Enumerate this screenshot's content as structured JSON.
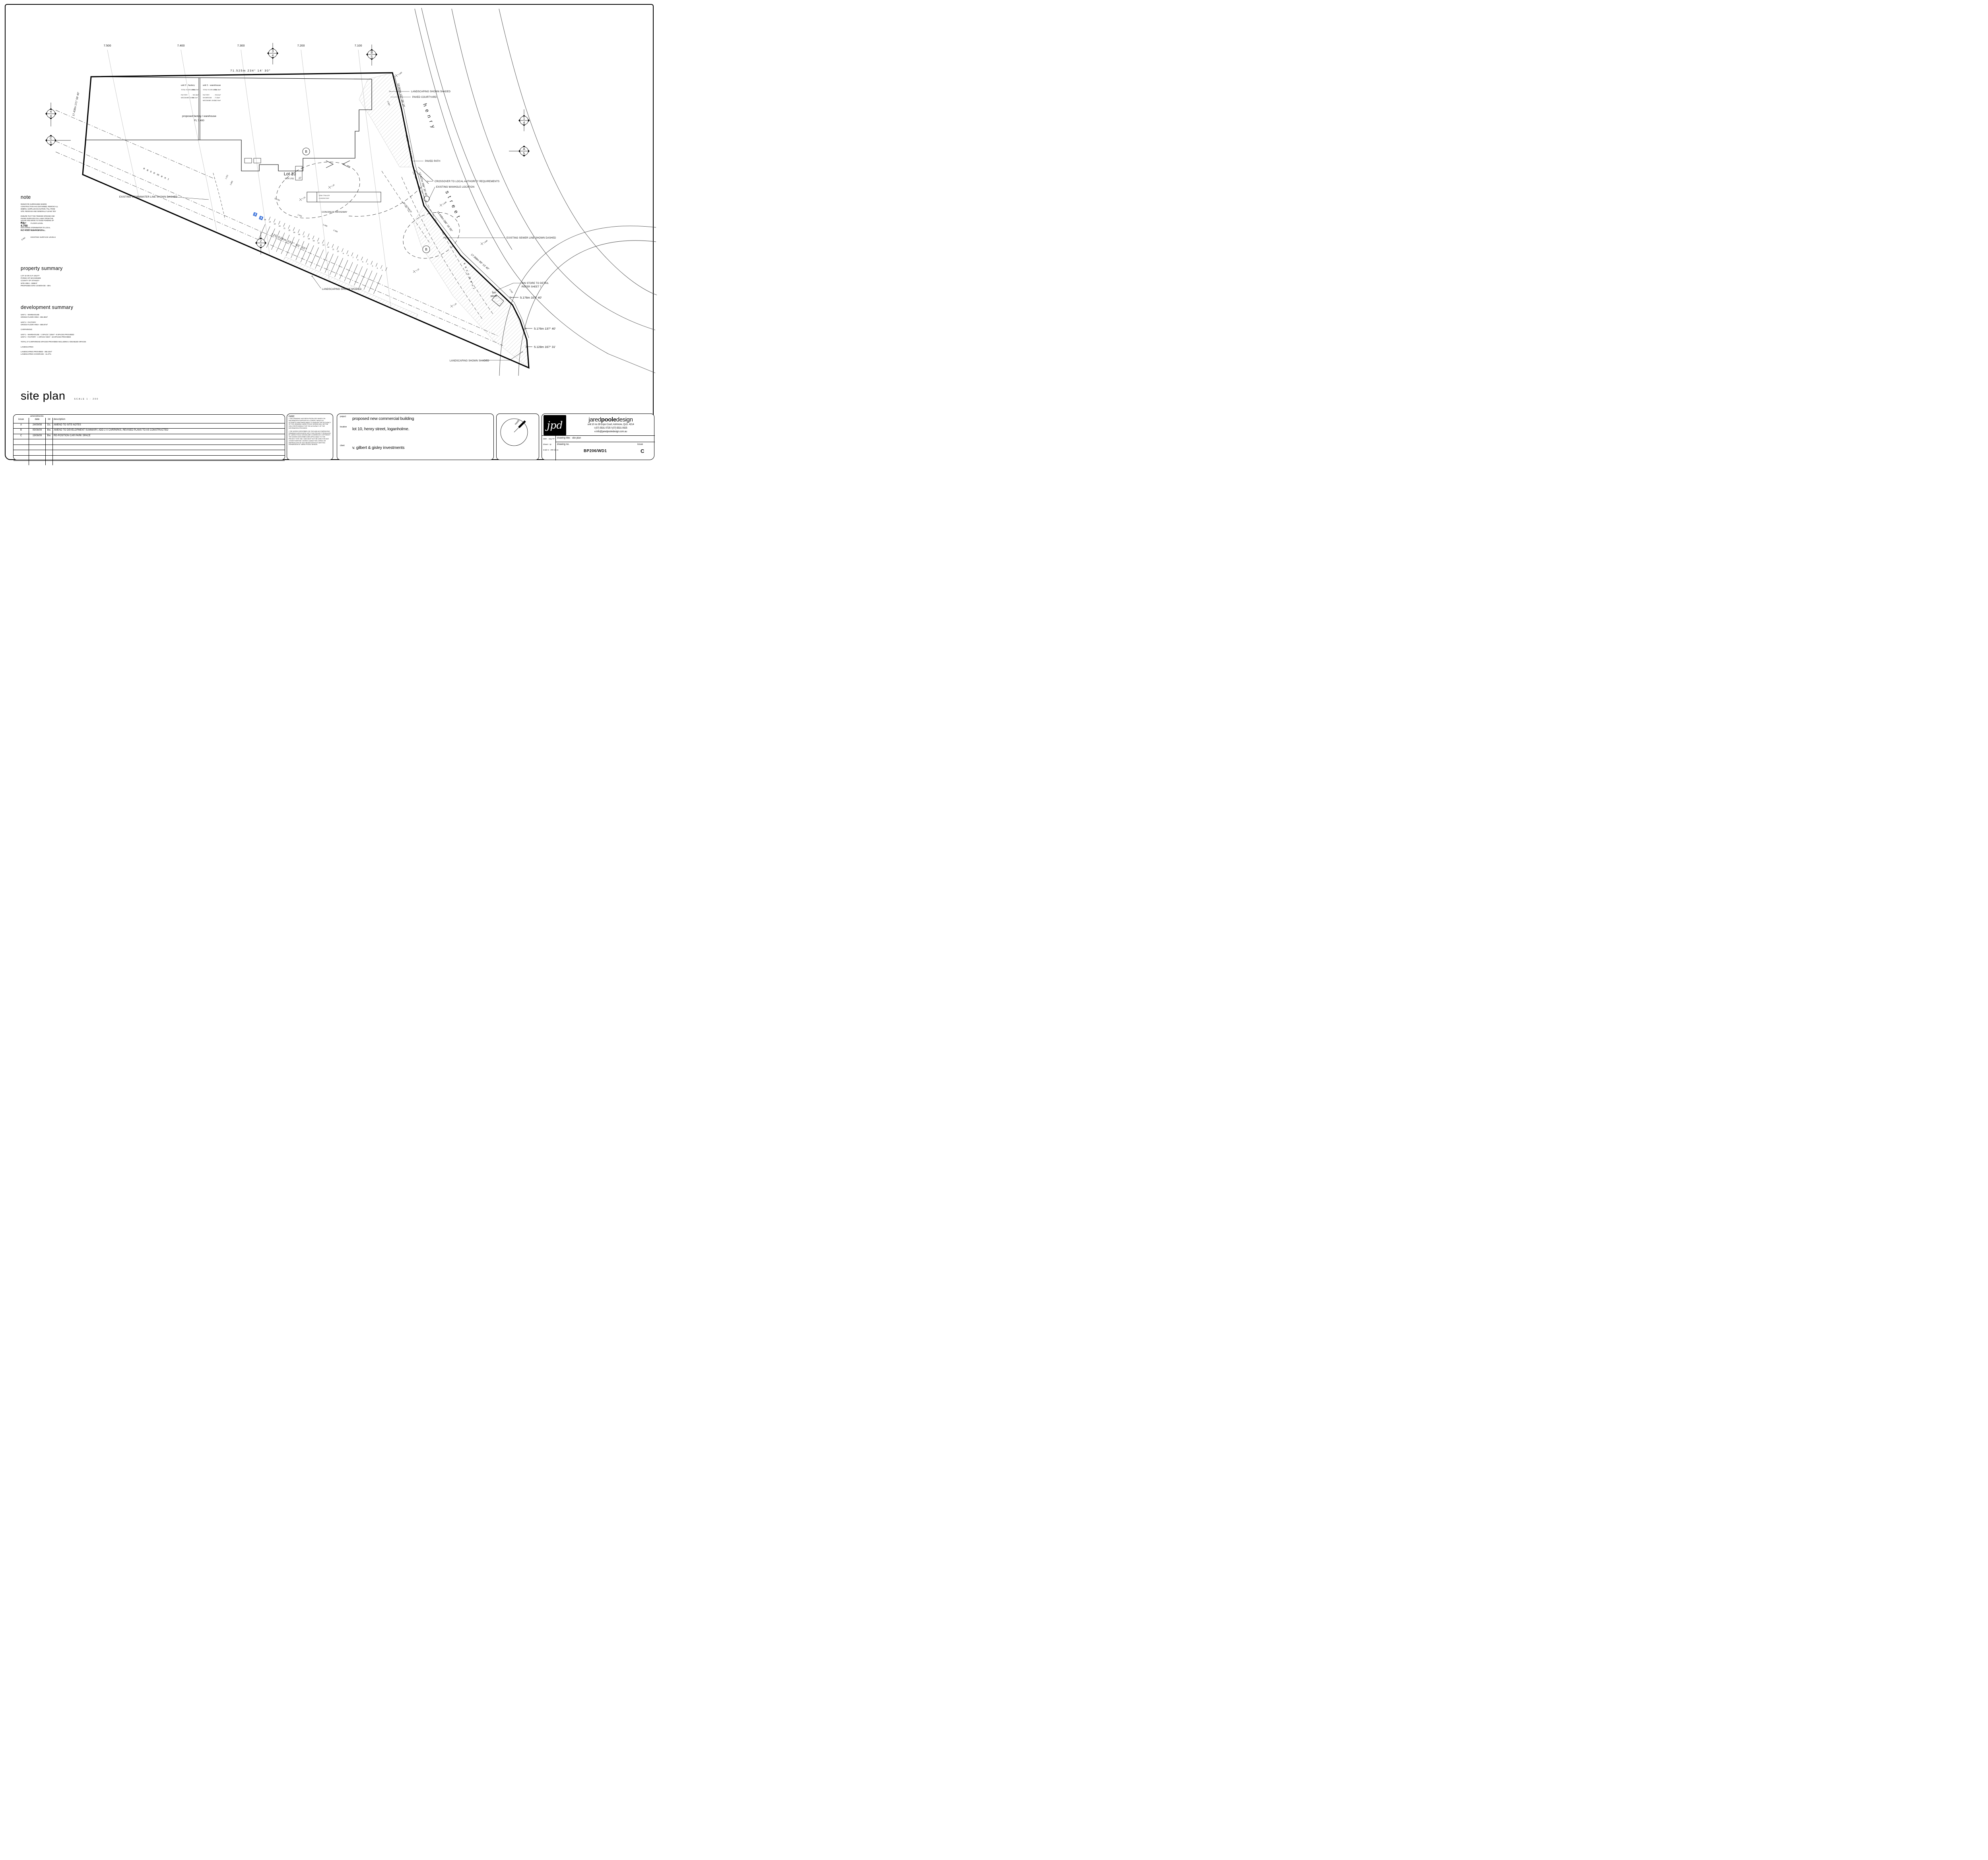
{
  "plan": {
    "contour_labels": [
      "7.500",
      "7.400",
      "7.300",
      "7.200",
      "7.100"
    ],
    "top_dim": "71.525m  234° 14' 30\"",
    "left_dim": "17.428m  171° 59' 40\"",
    "bottom_dim": "125.538m  262° 00' 30\"",
    "street_dims": [
      "10.043m  137° 06' 10\"",
      "12.837m  130° 54' 20\"",
      "12.837m  298° 30' 45\"",
      "14.448m  286° 16' 05\"",
      "17.368m  99° 13' 40\""
    ],
    "end_dims": [
      "5.176m  107° 40'",
      "5.176m  137° 40'",
      "5.128m  167° 31'"
    ],
    "markers": [
      {
        "top": "3",
        "bottom": "4"
      },
      {
        "top": "B",
        "bottom": "5"
      },
      {
        "top": "4",
        "bottom": "4"
      },
      {
        "top": "C",
        "bottom": "5"
      },
      {
        "top": "1",
        "bottom": "4"
      },
      {
        "top": "A",
        "bottom": "5"
      },
      {
        "top": "2",
        "bottom": "4"
      }
    ],
    "bubble": "B",
    "street_name_1": "henry",
    "street_name_2": "street",
    "easement": "easement",
    "setback_label": "8m SETBACK",
    "lot": {
      "title": "Lot 10",
      "sub": "GTP 1701",
      "space": "27"
    },
    "units": {
      "unit2": {
        "title": "unit 2 - factory",
        "rows": [
          {
            "label": "TOTAL FLOOR AREA",
            "value": "-   866.87m²"
          },
          {
            "label": "FACTORY",
            "value": "-   780.18m²"
          },
          {
            "label": "MEZZANINE LEVEL",
            "value": "-   86.01m²"
          }
        ]
      },
      "unit1": {
        "title": "unit 1 - warehouse",
        "rows": [
          {
            "label": "TOTAL FLOOR AREA",
            "value": "-   894.38m²"
          },
          {
            "label": "FACTORY",
            "value": "-   703.61m²"
          },
          {
            "label": "SHOWROOM",
            "value": "-   77.83m²"
          },
          {
            "label": "MEZZANINE LEVEL",
            "value": "-   112.94m²"
          }
        ]
      }
    },
    "building": {
      "label": "proposed factory / warehouse",
      "level": "FL 7.400"
    },
    "callouts": {
      "landscaping_top": "LANDSCAPING SHOWN SHADED",
      "paved_courtyard": "PAVED COURTYARD",
      "paved_path": "PAVED PATH",
      "crossover": "CROSSOVER TO LOCAL AUTHORITY REQUIREMENTS",
      "manhole": "EXISTING MANHOLE LOCATION",
      "sewer": "EXISTING SEWER LINE SHOWN DASHED",
      "bin_detail_1": "BIN STORE TO DETAIL",
      "bin_detail_2": "REFER SHEET 7",
      "bin_1": "bin",
      "bin_2": "store",
      "landscaping_bottom": "LANDSCAPING SHOWN SHADED",
      "landscaping_mid": "LANDSCAPING SHOWN SHADED",
      "stormwater": "EXISTING STORMWATER LINE SHOWN DASHED",
      "loading_1": "SEMI TRAILER",
      "loading_2": "LOADING BAY",
      "concrete": "CONCRETE DRIVEWAY"
    },
    "levels": [
      "7.040",
      "7.045",
      "7.040",
      "7.16",
      "7.31",
      "7.15",
      "7.19"
    ],
    "small_dims": {
      "a": "22.700",
      "b": "1.315",
      "c": "2.900",
      "d": "1.010",
      "e": "2.400",
      "f": "2.400",
      "g": "2.439",
      "h": "6,000"
    },
    "parking_numbers": [
      "25",
      "24",
      "23",
      "22",
      "21",
      "20",
      "19",
      "18",
      "17",
      "16",
      "15",
      "14",
      "13",
      "12",
      "11",
      "10",
      "9",
      "8",
      "7",
      "6",
      "5",
      "4",
      "3",
      "2",
      "1"
    ]
  },
  "notes": {
    "heading": "note",
    "paras": [
      "REINSTATE SURROUNDS WHERE CONSTRUCTION HAS DISTURBED, REMOVE ALL DEBRIS, SURPLUS EXCAVATION / FILL FROM SITE. REGRASS AND GENERALLY LEAVE TIDY",
      "ENSURE THAT THE FINISHED GROUND AND PAVING SURFACES FALL AWAY FROM THE HOUSE AND DRAIN TO AVOID PONDING OF WATER",
      "DISCHARGE STORMWATER TO LOCAL AUTHORITY REQUIREMENTS"
    ]
  },
  "legend": {
    "fl_value": "F.L. 4.750",
    "fl_label": "FLOOR LEVEL",
    "rl_value": "R.L. 4.500",
    "rl_label": "SURFACE LEVEL",
    "esl_value": "8.650",
    "esl_label": "EXISTING SURFACE LEVELS"
  },
  "property": {
    "heading": "property summary",
    "lines": [
      "LOT 10 ON S.P. 191277",
      "PARISH OF MACKENZIE",
      "COUNTY OF STANLEY",
      "SITE AREA - 3390m²",
      "PROPOSED SITE COVERAGE - 46%"
    ]
  },
  "development": {
    "heading": "development summary",
    "lines": [
      "UNIT 1 - WAREHOUSE",
      "GROSS FLOOR AREA - 894.38m²",
      "",
      "UNIT 2 - FACTORY",
      "GROSS FLOOR AREA - 866.87m²",
      "",
      "CARPARKING",
      "",
      "UNIT 1 - WAREHOUSE - 1 SPACE / 100m² - 9 SPACES PROVIDED",
      "UNIT 2 - FACTORY - 1 SPACE / 50m² - 18 SPACES PROVIDED",
      "",
      "TOTAL 27 CARPARKING SPACES PROVIDED INCLUDING 2 DISABLED SPACES",
      "",
      "LANDSCAPING",
      "",
      "LANDSCAPING PROVIDED - 382.22m²",
      "LANDSCAPING COVERAGE - 11.27%"
    ]
  },
  "site_title": {
    "text": "site plan",
    "scale": "SCALE 1 : 200"
  },
  "amendments": {
    "title": "amendments",
    "headers": [
      "issue",
      "date",
      "int",
      "description"
    ],
    "rows": [
      {
        "issue": "A",
        "date": "24/09/08",
        "int": "Ds.",
        "description": "AMEND TO SITE NOTES"
      },
      {
        "issue": "B",
        "date": "05/08/09",
        "int": "Bw.",
        "description": "AMEND TO DEVELOPMENT SUMMARY, ADD 2 X CARPARKS, REVISED PLANS TO AS CONSTRUCTED"
      },
      {
        "issue": "C",
        "date": "19/08/09",
        "int": "Bw.",
        "description": "RE-POSITION CAR PARK SPACE"
      }
    ],
    "empty_rows": 5
  },
  "disclaimer": {
    "heading": "note:",
    "bullets": [
      "THIS DRAWING HAS BEEN PRODUCED BASED ON INFORMATION SUPPLIED BY OTHERS. WHILE ALL ATTEMPTS HAVE BEEN MADE TO ENSURE THE ACCURACY OF THE DRAWING JARED POOLE DESIGN WILL NOT BE HELD RESPONSIBLE FOR THE ACCURACY OF THE INFORMATION PROVIDED",
      "THE WORKS DESCRIBED ON THIS AND ACCOMPANYING DRAWINGS ASSOCIATED WITH THIS PROJECT PRODUCED BY JARED POOLE DESIGN ARE COVERED BY COPYRIGHT. THE WORKS DESCRIBED ARE APPLICABLE TO THE PROJECT SITE ONLY AND MUST NOT BE USED FOR ANY OTHER PURPOSE. WORKS CANNOT BE COPIED OR REPRODUCED BY ANY MEANS WITHOUT WRITTEN PERMISSION OF JARED POOLE DESIGN"
    ]
  },
  "project": {
    "project_label": "project",
    "project": "proposed new commercial building",
    "location_label": "location",
    "location": "lot 10, henry street, loganholme.",
    "client_label": "client",
    "client": "v. gilbert & gisley investments"
  },
  "north": {
    "label": "north"
  },
  "firm": {
    "logo": "jpd",
    "name_1": "jared",
    "name_2": "poole",
    "name_3": "design",
    "address": "unit 10 no 28 Expo Court, Ashmore, QLD. 4214",
    "phone": "t (07) 5531 0725      f (07) 5531 0925",
    "email": "e info@jaredpooledesign.com.au",
    "date_label": "date:",
    "date": "aug '07",
    "drawn_label": "drawn:",
    "drawn": "Jp",
    "scale_label": "scale:",
    "scale": "1 : 200 @ a1",
    "title_label": "drawing title:",
    "drawing_title": "site plan",
    "no_label": "drawing no.",
    "no": "BP206/WD1",
    "issue_label": "issue",
    "issue": "C"
  }
}
